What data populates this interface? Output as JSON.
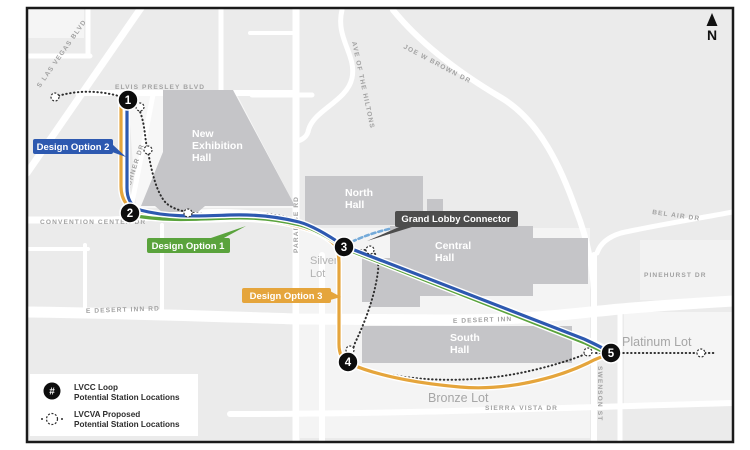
{
  "north_indicator": {
    "label": "N"
  },
  "streets": {
    "s_las_vegas_blvd": "S LAS VEGAS BLVD",
    "elvis_presley_blvd": "ELVIS PRESLEY BLVD",
    "kishner_dr": "KISHNER DR",
    "convention_center_dr": "CONVENTION CENTER DR",
    "paradise_rd": "PARADISE RD",
    "ave_of_the_hiltons": "AVE OF THE HILTONS",
    "joe_w_brown_dr": "JOE W BROWN DR",
    "bel_air_dr": "BEL AIR DR",
    "pinehurst_dr": "PINEHURST DR",
    "e_desert_inn_rd": "E DESERT INN RD",
    "e_desert_inn": "E DESERT INN",
    "sierra_vista_dr": "SIERRA VISTA DR",
    "swenson_st": "SWENSON ST"
  },
  "buildings": {
    "new_exhibition_hall": {
      "lines": [
        "New",
        "Exhibition",
        "Hall"
      ]
    },
    "north_hall": {
      "lines": [
        "North",
        "Hall"
      ]
    },
    "central_hall": {
      "lines": [
        "Central",
        "Hall"
      ]
    },
    "south_hall": {
      "lines": [
        "South",
        "Hall"
      ]
    }
  },
  "lots": {
    "silver": {
      "lines": [
        "Silver",
        "Lot"
      ]
    },
    "platinum": "Platinum Lot",
    "bronze": "Bronze Lot"
  },
  "routes": [
    {
      "id": "design-option-1",
      "label": "Design Option 1",
      "color": "#5aa33c"
    },
    {
      "id": "design-option-2",
      "label": "Design Option 2",
      "color": "#2d59b0"
    },
    {
      "id": "design-option-3",
      "label": "Design Option 3",
      "color": "#e5a53c"
    }
  ],
  "connector": {
    "label": "Grand Lobby Connector",
    "color": "#74aad9",
    "label_bg": "#4d4d4d"
  },
  "stations": [
    {
      "number": "1"
    },
    {
      "number": "2"
    },
    {
      "number": "3"
    },
    {
      "number": "4"
    },
    {
      "number": "5"
    }
  ],
  "legend": {
    "items": [
      {
        "icon": "numbered-station-icon",
        "icon_glyph": "#",
        "line1": "LVCC Loop",
        "line2": "Potential Station Locations"
      },
      {
        "icon": "dotted-station-icon",
        "line1": "LVCVA Proposed",
        "line2": "Potential Station Locations"
      }
    ]
  },
  "colors": {
    "map_background": "#ebebeb",
    "lot_patch": "#f5f5f5",
    "road": "#ffffff",
    "building": "#c5c5c8",
    "route_green": "#5aa33c",
    "route_blue": "#2d59b0",
    "route_orange": "#e5a53c",
    "dotted_route": "#2e2e2e",
    "connector_blue": "#74aad9",
    "connector_label_bg": "#4d4d4d",
    "station_fill": "#0d0d0d",
    "border": "#1a1a1a"
  }
}
